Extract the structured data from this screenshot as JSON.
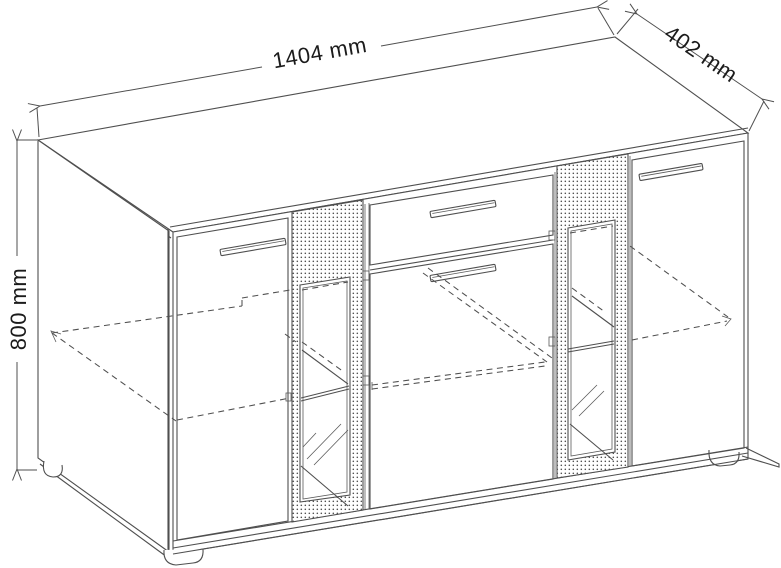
{
  "drawing": {
    "dimensions": {
      "width": {
        "label": "1404 mm"
      },
      "depth": {
        "label": "402 mm"
      },
      "height": {
        "label": "800 mm"
      }
    },
    "colors": {
      "line": "#4f4f4f",
      "text": "#1b1b1b",
      "background": "#ffffff"
    }
  }
}
